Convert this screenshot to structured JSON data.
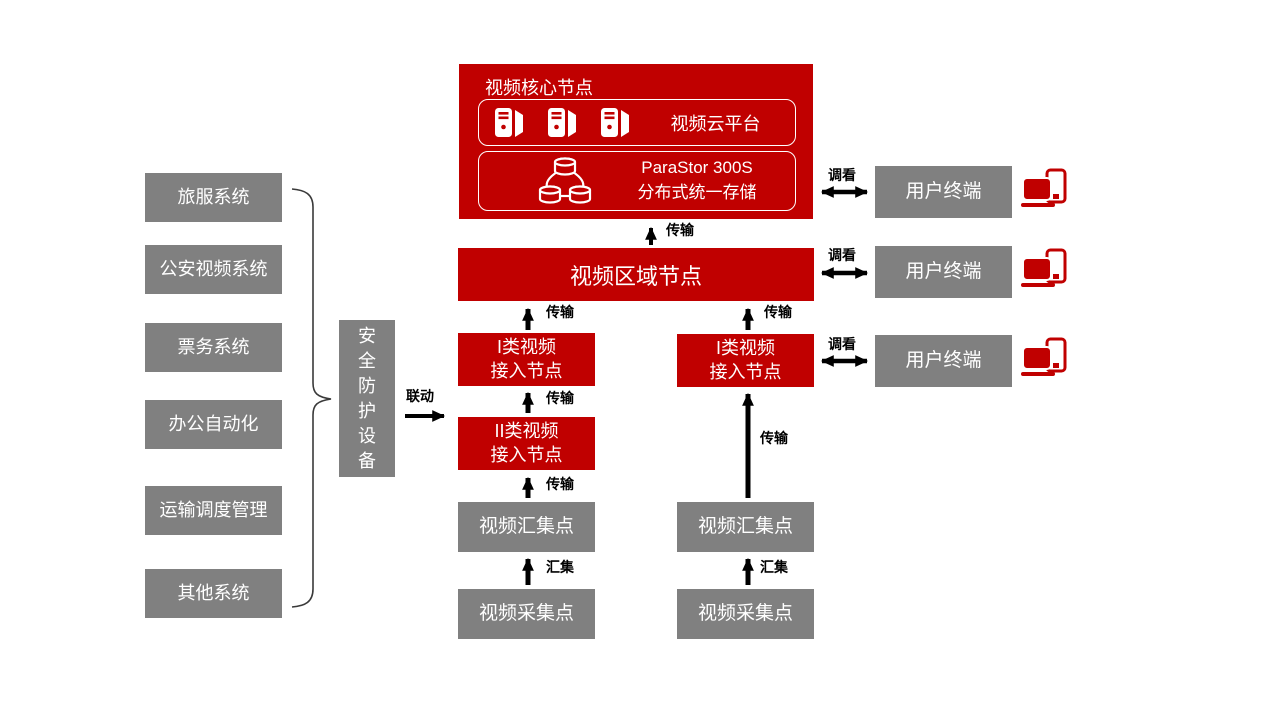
{
  "colors": {
    "red": "#C00000",
    "gray": "#808080",
    "text_light": "#FFFFFF",
    "arrow": "#000000"
  },
  "left_systems": [
    {
      "label": "旅服系统"
    },
    {
      "label": "公安视频系统"
    },
    {
      "label": "票务系统"
    },
    {
      "label": "办公自动化"
    },
    {
      "label": "运输调度管理"
    },
    {
      "label": "其他系统"
    }
  ],
  "security_device": {
    "label": "安全防护设备"
  },
  "core_node": {
    "title": "视频核心节点",
    "cloud_platform": {
      "label": "视频云平台"
    },
    "storage": {
      "product": "ParaStor 300S",
      "description": "分布式统一存储"
    }
  },
  "region_node": {
    "label": "视频区域节点"
  },
  "left_chain": {
    "access1": {
      "line1": "I类视频",
      "line2": "接入节点"
    },
    "access2": {
      "line1": "II类视频",
      "line2": "接入节点"
    },
    "aggregation": {
      "label": "视频汇集点"
    },
    "collection": {
      "label": "视频采集点"
    }
  },
  "right_chain": {
    "access1": {
      "line1": "I类视频",
      "line2": "接入节点"
    },
    "aggregation": {
      "label": "视频汇集点"
    },
    "collection": {
      "label": "视频采集点"
    }
  },
  "user_terminals": [
    {
      "label": "用户终端"
    },
    {
      "label": "用户终端"
    },
    {
      "label": "用户终端"
    }
  ],
  "edge_labels": {
    "transmission": "传输",
    "aggregation": "汇集",
    "view": "调看",
    "linkage": "联动"
  }
}
